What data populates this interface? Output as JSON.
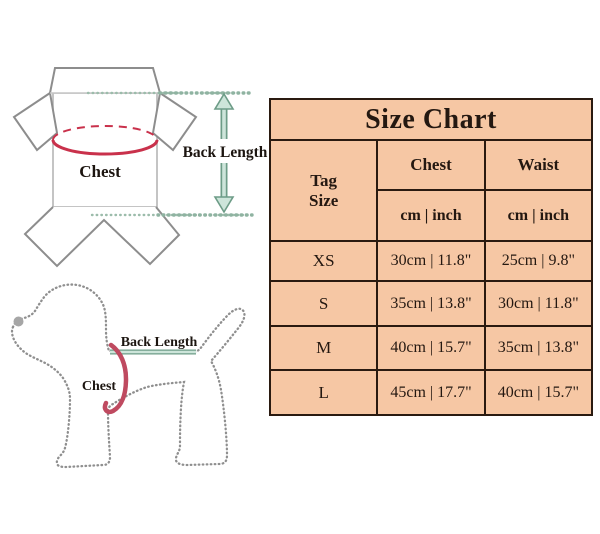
{
  "garment_diagram": {
    "chest_label": "Chest",
    "back_length_label": "Back Length"
  },
  "dog_diagram": {
    "chest_label": "Chest",
    "back_length_label": "Back Length"
  },
  "size_chart": {
    "title": "Size Chart",
    "tag_header_line1": "Tag",
    "tag_header_line2": "Size",
    "columns": [
      {
        "label": "Chest",
        "unit": "cm | inch"
      },
      {
        "label": "Waist",
        "unit": "cm | inch"
      }
    ],
    "rows": [
      {
        "tag": "XS",
        "chest": "30cm | 11.8\"",
        "waist": "25cm | 9.8\""
      },
      {
        "tag": "S",
        "chest": "35cm | 13.8\"",
        "waist": "30cm | 11.8\""
      },
      {
        "tag": "M",
        "chest": "40cm | 15.7\"",
        "waist": "35cm | 13.8\""
      },
      {
        "tag": "L",
        "chest": "45cm | 17.7\"",
        "waist": "40cm | 15.7\""
      }
    ]
  },
  "colors": {
    "table_background": "#f6c7a4",
    "table_border": "#2a1a10",
    "chest_ellipse_red": "#c9314b",
    "dog_chest_pink": "#bf4a60",
    "measure_teal_dark": "#6d9c87",
    "measure_teal_light": "#cde5da",
    "outline_gray": "#8f8f8f"
  }
}
